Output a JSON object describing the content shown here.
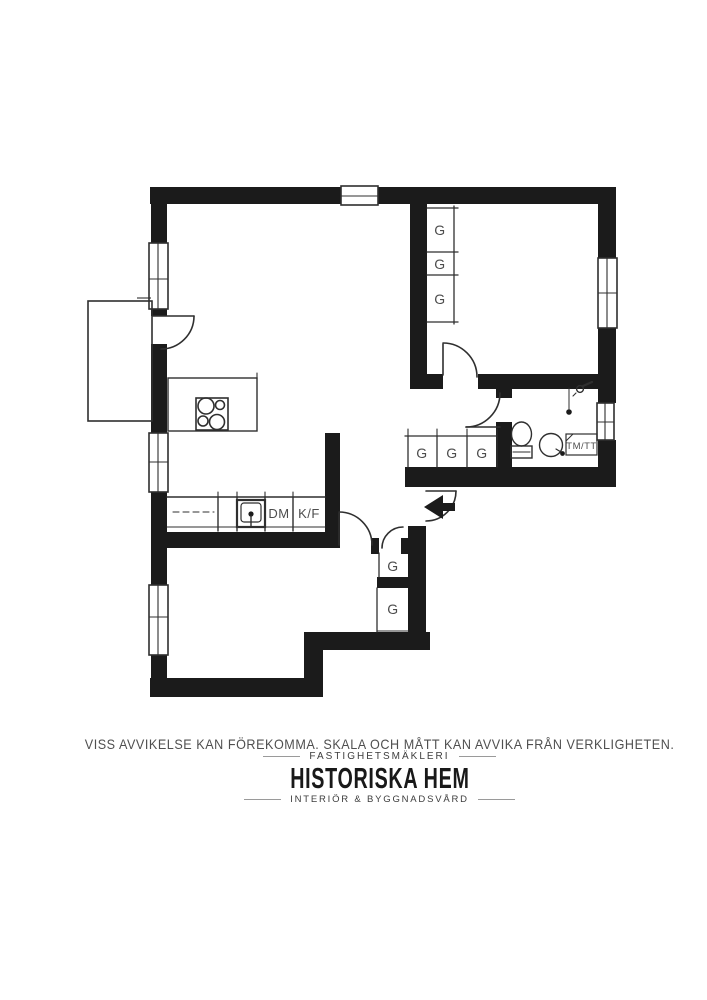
{
  "plan": {
    "wardrobe_label": "G",
    "dishwasher_label": "DM",
    "fridge_freezer_label": "K/F",
    "washer_dryer_label": "TM/TT"
  },
  "footer": {
    "disclaimer": "VISS AVVIKELSE KAN FÖREKOMMA. SKALA OCH MÅTT KAN AVVIKA FRÅN VERKLIGHETEN.",
    "brand_category": "FASTIGHETSMÄKLERI",
    "brand_name": "HISTORISKA HEM",
    "brand_tagline": "INTERIÖR & BYGGNADSVÅRD"
  },
  "colors": {
    "wall": "#1b1b1b",
    "line": "#2f2f2f",
    "label": "#4d4d4d",
    "background": "#ffffff"
  }
}
